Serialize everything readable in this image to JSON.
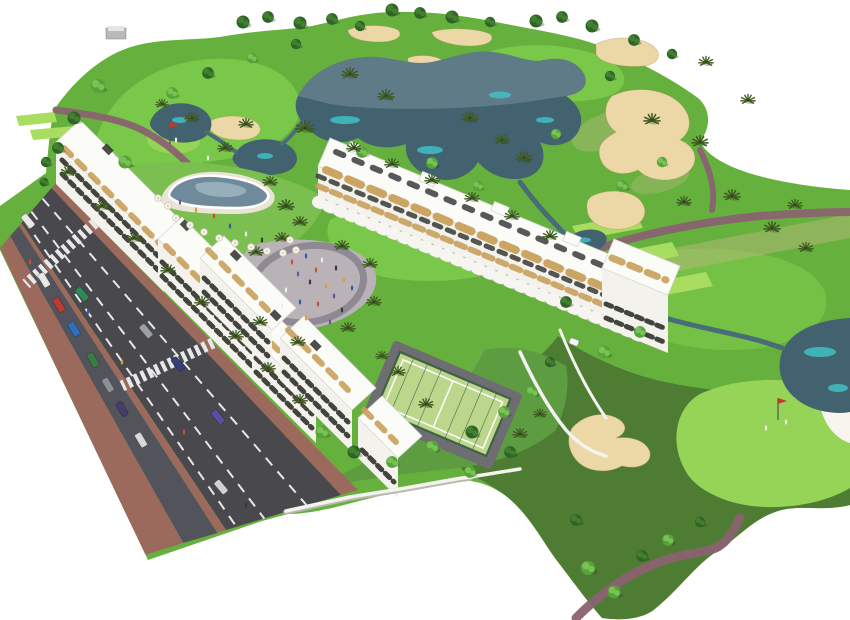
{
  "scene": {
    "type": "aerial-3d-architectural-rendering",
    "subject": "white-apartment-resort-complex-beside-golf-course",
    "features": [
      "golf-course",
      "lakes",
      "sand-bunkers",
      "cart-paths",
      "tee-boxes",
      "putting-greens",
      "apartment-blocks",
      "rooftop-terraces",
      "swimming-pool-courtyard",
      "central-plaza",
      "padel-court",
      "gardens",
      "boundary-walls",
      "avenue-with-traffic",
      "crosswalks",
      "parked-cars",
      "palm-trees",
      "pedestrians",
      "golf-flags",
      "golf-cart"
    ]
  },
  "palette": {
    "grass_base": "#66b13d",
    "grass_light": "#7ccb4b",
    "grass_tee": "#a8dd60",
    "grass_green": "#95d456",
    "grass_dark": "#4e7c33",
    "lawn": "#7abf4f",
    "garden": "#5d9c41",
    "dry_grass": "#b5b97c",
    "water_dark": "#42626f",
    "water_gray": "#7b93a0",
    "water_cyan": "#3fc6cb",
    "water_stroke": "#4a6b78",
    "pool_water": "#6f8b9b",
    "sand": "#ecd8a6",
    "sand_white": "#f8f5ee",
    "path": "#8a6370",
    "road": "#48484d",
    "road_parking": "#53535b",
    "sidewalk": "#9c6a5c",
    "lane_marking": "#e8e8e8",
    "building": "#f3f2ed",
    "roof": "#fbfbf8",
    "window": "#44443e",
    "wood": "#c9a05c",
    "pergola": "#2f2f2f",
    "wall": "#f4f4ef",
    "plaza": "#b9b3b7",
    "plaza_ring": "#8f8993",
    "court": "#bcd78b",
    "court_fence": "#3e6246",
    "court_path": "#6e6e72",
    "tree_dark": "#2e6527",
    "tree_dark2": "#447f31",
    "tree_light": "#57a33b",
    "tree_light2": "#79c254",
    "palm": "#3f5a22",
    "background": "#ffffff"
  },
  "objects": {
    "trees": [
      {
        "x": 243,
        "y": 22,
        "s": 1,
        "v": "dark"
      },
      {
        "x": 268,
        "y": 17,
        "s": 0.9,
        "v": "dark"
      },
      {
        "x": 300,
        "y": 23,
        "s": 1,
        "v": "dark"
      },
      {
        "x": 332,
        "y": 19,
        "s": 0.9,
        "v": "dark"
      },
      {
        "x": 360,
        "y": 26,
        "s": 0.8,
        "v": "dark"
      },
      {
        "x": 392,
        "y": 10,
        "s": 1,
        "v": "dark"
      },
      {
        "x": 420,
        "y": 13,
        "s": 0.9,
        "v": "dark"
      },
      {
        "x": 452,
        "y": 17,
        "s": 1,
        "v": "dark"
      },
      {
        "x": 490,
        "y": 22,
        "s": 0.8,
        "v": "dark"
      },
      {
        "x": 536,
        "y": 21,
        "s": 1,
        "v": "dark"
      },
      {
        "x": 562,
        "y": 17,
        "s": 0.9,
        "v": "dark"
      },
      {
        "x": 592,
        "y": 26,
        "s": 1,
        "v": "dark"
      },
      {
        "x": 634,
        "y": 40,
        "s": 0.9,
        "v": "dark"
      },
      {
        "x": 672,
        "y": 54,
        "s": 0.8,
        "v": "dark"
      },
      {
        "x": 98,
        "y": 86,
        "s": 1.1,
        "v": "light"
      },
      {
        "x": 74,
        "y": 118,
        "s": 1,
        "v": "dark"
      },
      {
        "x": 58,
        "y": 148,
        "s": 0.9,
        "v": "dark"
      },
      {
        "x": 125,
        "y": 162,
        "s": 1,
        "v": "light"
      },
      {
        "x": 172,
        "y": 93,
        "s": 0.9,
        "v": "light"
      },
      {
        "x": 208,
        "y": 73,
        "s": 0.9,
        "v": "dark"
      },
      {
        "x": 252,
        "y": 58,
        "s": 0.8,
        "v": "light"
      },
      {
        "x": 296,
        "y": 44,
        "s": 0.8,
        "v": "dark"
      },
      {
        "x": 350,
        "y": 74,
        "s": 0.9,
        "v": "palm"
      },
      {
        "x": 386,
        "y": 96,
        "s": 0.9,
        "v": "palm"
      },
      {
        "x": 305,
        "y": 128,
        "s": 1,
        "v": "palm"
      },
      {
        "x": 362,
        "y": 152,
        "s": 0.9,
        "v": "light"
      },
      {
        "x": 470,
        "y": 118,
        "s": 0.9,
        "v": "palm"
      },
      {
        "x": 502,
        "y": 140,
        "s": 0.8,
        "v": "palm"
      },
      {
        "x": 432,
        "y": 163,
        "s": 0.9,
        "v": "light"
      },
      {
        "x": 478,
        "y": 186,
        "s": 0.8,
        "v": "light"
      },
      {
        "x": 524,
        "y": 158,
        "s": 0.9,
        "v": "palm"
      },
      {
        "x": 556,
        "y": 134,
        "s": 0.8,
        "v": "light"
      },
      {
        "x": 610,
        "y": 76,
        "s": 0.8,
        "v": "dark"
      },
      {
        "x": 652,
        "y": 120,
        "s": 0.9,
        "v": "palm"
      },
      {
        "x": 700,
        "y": 142,
        "s": 0.9,
        "v": "palm"
      },
      {
        "x": 662,
        "y": 162,
        "s": 0.8,
        "v": "light"
      },
      {
        "x": 622,
        "y": 186,
        "s": 0.9,
        "v": "light"
      },
      {
        "x": 684,
        "y": 202,
        "s": 0.8,
        "v": "palm"
      },
      {
        "x": 732,
        "y": 196,
        "s": 0.9,
        "v": "palm"
      },
      {
        "x": 772,
        "y": 228,
        "s": 0.9,
        "v": "palm"
      },
      {
        "x": 806,
        "y": 248,
        "s": 0.8,
        "v": "palm"
      },
      {
        "x": 246,
        "y": 124,
        "s": 0.8,
        "v": "palm"
      },
      {
        "x": 225,
        "y": 148,
        "s": 0.8,
        "v": "palm"
      },
      {
        "x": 192,
        "y": 118,
        "s": 0.8,
        "v": "palm"
      },
      {
        "x": 162,
        "y": 104,
        "s": 0.7,
        "v": "palm"
      },
      {
        "x": 706,
        "y": 62,
        "s": 0.8,
        "v": "palm"
      },
      {
        "x": 748,
        "y": 100,
        "s": 0.8,
        "v": "palm"
      },
      {
        "x": 795,
        "y": 205,
        "s": 0.8,
        "v": "palm"
      },
      {
        "x": 640,
        "y": 332,
        "s": 0.9,
        "v": "light"
      },
      {
        "x": 604,
        "y": 352,
        "s": 1,
        "v": "light"
      },
      {
        "x": 566,
        "y": 302,
        "s": 0.9,
        "v": "dark"
      },
      {
        "x": 588,
        "y": 568,
        "s": 1.1,
        "v": "light"
      },
      {
        "x": 614,
        "y": 592,
        "s": 1,
        "v": "light"
      },
      {
        "x": 642,
        "y": 556,
        "s": 0.9,
        "v": "dark"
      },
      {
        "x": 668,
        "y": 540,
        "s": 0.9,
        "v": "light"
      },
      {
        "x": 700,
        "y": 522,
        "s": 0.8,
        "v": "dark"
      },
      {
        "x": 576,
        "y": 520,
        "s": 0.9,
        "v": "dark"
      },
      {
        "x": 68,
        "y": 172,
        "s": 0.8,
        "v": "palm"
      },
      {
        "x": 102,
        "y": 206,
        "s": 0.8,
        "v": "palm"
      },
      {
        "x": 134,
        "y": 238,
        "s": 0.8,
        "v": "palm"
      },
      {
        "x": 168,
        "y": 270,
        "s": 0.8,
        "v": "palm"
      },
      {
        "x": 202,
        "y": 302,
        "s": 0.8,
        "v": "palm"
      },
      {
        "x": 236,
        "y": 336,
        "s": 0.8,
        "v": "palm"
      },
      {
        "x": 268,
        "y": 368,
        "s": 0.8,
        "v": "palm"
      },
      {
        "x": 300,
        "y": 400,
        "s": 0.8,
        "v": "palm"
      },
      {
        "x": 46,
        "y": 162,
        "s": 0.8,
        "v": "dark"
      },
      {
        "x": 44,
        "y": 182,
        "s": 0.7,
        "v": "dark"
      },
      {
        "x": 256,
        "y": 252,
        "s": 0.8,
        "v": "palm"
      },
      {
        "x": 282,
        "y": 238,
        "s": 0.8,
        "v": "palm"
      },
      {
        "x": 342,
        "y": 246,
        "s": 0.8,
        "v": "palm"
      },
      {
        "x": 370,
        "y": 264,
        "s": 0.8,
        "v": "palm"
      },
      {
        "x": 374,
        "y": 302,
        "s": 0.8,
        "v": "palm"
      },
      {
        "x": 348,
        "y": 328,
        "s": 0.8,
        "v": "palm"
      },
      {
        "x": 298,
        "y": 342,
        "s": 0.8,
        "v": "palm"
      },
      {
        "x": 260,
        "y": 322,
        "s": 0.8,
        "v": "palm"
      },
      {
        "x": 322,
        "y": 432,
        "s": 1,
        "v": "light"
      },
      {
        "x": 354,
        "y": 452,
        "s": 1,
        "v": "dark"
      },
      {
        "x": 392,
        "y": 462,
        "s": 0.9,
        "v": "light"
      },
      {
        "x": 432,
        "y": 447,
        "s": 1,
        "v": "light"
      },
      {
        "x": 472,
        "y": 432,
        "s": 1,
        "v": "dark"
      },
      {
        "x": 504,
        "y": 412,
        "s": 0.9,
        "v": "light"
      },
      {
        "x": 532,
        "y": 392,
        "s": 0.9,
        "v": "light"
      },
      {
        "x": 550,
        "y": 362,
        "s": 0.8,
        "v": "dark"
      },
      {
        "x": 470,
        "y": 472,
        "s": 0.9,
        "v": "light"
      },
      {
        "x": 510,
        "y": 452,
        "s": 0.9,
        "v": "dark"
      },
      {
        "x": 426,
        "y": 404,
        "s": 0.8,
        "v": "palm"
      },
      {
        "x": 398,
        "y": 372,
        "s": 0.8,
        "v": "palm"
      },
      {
        "x": 382,
        "y": 356,
        "s": 0.7,
        "v": "palm"
      },
      {
        "x": 520,
        "y": 434,
        "s": 0.8,
        "v": "palm"
      },
      {
        "x": 540,
        "y": 414,
        "s": 0.7,
        "v": "palm"
      },
      {
        "x": 354,
        "y": 148,
        "s": 0.8,
        "v": "palm"
      },
      {
        "x": 392,
        "y": 164,
        "s": 0.8,
        "v": "palm"
      },
      {
        "x": 432,
        "y": 180,
        "s": 0.8,
        "v": "palm"
      },
      {
        "x": 472,
        "y": 198,
        "s": 0.8,
        "v": "palm"
      },
      {
        "x": 512,
        "y": 216,
        "s": 0.8,
        "v": "palm"
      },
      {
        "x": 550,
        "y": 236,
        "s": 0.8,
        "v": "palm"
      },
      {
        "x": 286,
        "y": 206,
        "s": 0.9,
        "v": "palm"
      },
      {
        "x": 300,
        "y": 222,
        "s": 0.8,
        "v": "palm"
      },
      {
        "x": 270,
        "y": 182,
        "s": 0.8,
        "v": "palm"
      }
    ],
    "cars": [
      {
        "x": 44,
        "y": 280,
        "a": 59,
        "color": "#e8e8e8"
      },
      {
        "x": 59,
        "y": 305,
        "a": 59,
        "color": "#b93c34"
      },
      {
        "x": 74,
        "y": 329,
        "a": 59,
        "color": "#2f6fc0"
      },
      {
        "x": 93,
        "y": 360,
        "a": 59,
        "color": "#3a7d44"
      },
      {
        "x": 108,
        "y": 385,
        "a": 59,
        "color": "#8a8f96"
      },
      {
        "x": 122,
        "y": 409,
        "a": 59,
        "color": "#463d6e"
      },
      {
        "x": 141,
        "y": 440,
        "a": 59,
        "color": "#d8d8d8"
      },
      {
        "x": 218,
        "y": 417,
        "a": 50,
        "color": "#5a4fa0"
      },
      {
        "x": 146,
        "y": 331,
        "a": 50,
        "color": "#9aa0a6"
      },
      {
        "x": 82,
        "y": 294,
        "a": 50,
        "color": "#2e8b57"
      },
      {
        "x": 221,
        "y": 487,
        "a": 50,
        "color": "#cfd2d6"
      },
      {
        "x": 28,
        "y": 221,
        "a": 50,
        "color": "#e8e8e8"
      },
      {
        "x": 178,
        "y": 364,
        "a": 50,
        "color": "#35407a"
      }
    ],
    "people": [
      {
        "x": 292,
        "y": 262,
        "color": "#c8502f"
      },
      {
        "x": 306,
        "y": 256,
        "color": "#2f5fa8"
      },
      {
        "x": 322,
        "y": 260,
        "color": "#f0ede6"
      },
      {
        "x": 336,
        "y": 268,
        "color": "#3b3b3b"
      },
      {
        "x": 344,
        "y": 280,
        "color": "#d8a03a"
      },
      {
        "x": 334,
        "y": 296,
        "color": "#7a4fa0"
      },
      {
        "x": 318,
        "y": 304,
        "color": "#c8502f"
      },
      {
        "x": 300,
        "y": 302,
        "color": "#2f5fa8"
      },
      {
        "x": 286,
        "y": 290,
        "color": "#f0ede6"
      },
      {
        "x": 310,
        "y": 282,
        "color": "#3b3b3b"
      },
      {
        "x": 326,
        "y": 286,
        "color": "#d8a03a"
      },
      {
        "x": 298,
        "y": 274,
        "color": "#7a4fa0"
      },
      {
        "x": 316,
        "y": 270,
        "color": "#c8502f"
      },
      {
        "x": 352,
        "y": 288,
        "color": "#2f5fa8"
      },
      {
        "x": 282,
        "y": 306,
        "color": "#f0ede6"
      },
      {
        "x": 342,
        "y": 310,
        "color": "#3b3b3b"
      },
      {
        "x": 306,
        "y": 318,
        "color": "#d8a03a"
      },
      {
        "x": 330,
        "y": 322,
        "color": "#7a4fa0"
      },
      {
        "x": 214,
        "y": 216,
        "color": "#c8502f"
      },
      {
        "x": 230,
        "y": 226,
        "color": "#2f5fa8"
      },
      {
        "x": 246,
        "y": 234,
        "color": "#f0ede6"
      },
      {
        "x": 262,
        "y": 240,
        "color": "#3b3b3b"
      },
      {
        "x": 196,
        "y": 210,
        "color": "#d8a03a"
      },
      {
        "x": 180,
        "y": 202,
        "color": "#7a4fa0"
      },
      {
        "x": 30,
        "y": 262,
        "color": "#c8502f"
      },
      {
        "x": 88,
        "y": 312,
        "color": "#2f5fa8"
      },
      {
        "x": 122,
        "y": 362,
        "color": "#d8a03a"
      },
      {
        "x": 184,
        "y": 432,
        "color": "#c8502f"
      },
      {
        "x": 246,
        "y": 505,
        "color": "#3b3b3b"
      },
      {
        "x": 766,
        "y": 428,
        "color": "#f0ede6"
      },
      {
        "x": 786,
        "y": 422,
        "color": "#f0ede6"
      },
      {
        "x": 208,
        "y": 158,
        "color": "#f0ede6"
      },
      {
        "x": 176,
        "y": 140,
        "color": "#f0ede6"
      }
    ],
    "umbrellas": [
      {
        "x": 176,
        "y": 218
      },
      {
        "x": 190,
        "y": 225
      },
      {
        "x": 204,
        "y": 232
      },
      {
        "x": 219,
        "y": 238
      },
      {
        "x": 235,
        "y": 243
      },
      {
        "x": 251,
        "y": 247
      },
      {
        "x": 267,
        "y": 251
      },
      {
        "x": 283,
        "y": 253
      },
      {
        "x": 168,
        "y": 206
      },
      {
        "x": 158,
        "y": 198
      },
      {
        "x": 296,
        "y": 250
      },
      {
        "x": 290,
        "y": 240
      }
    ],
    "flags": [
      {
        "x": 170,
        "y": 122
      },
      {
        "x": 778,
        "y": 398
      }
    ]
  }
}
